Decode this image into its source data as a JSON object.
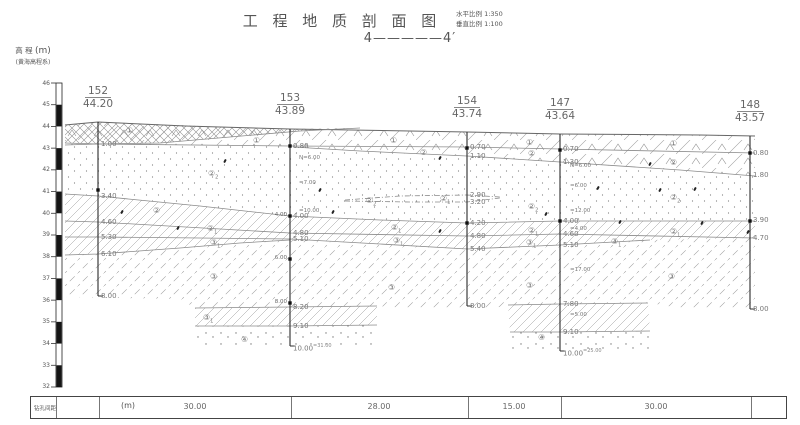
{
  "header": {
    "title": "工 程 地 质 剖 面 图",
    "scale_h_label": "水平比例",
    "scale_h_value": "1:350",
    "scale_v_label": "垂直比例",
    "scale_v_value": "1:100",
    "section_label": "4—————4′"
  },
  "axis": {
    "caption_line1": "高 程",
    "caption_unit": "(m)",
    "caption_line2": "(黄海高程系)",
    "ticks": [
      46,
      45,
      44,
      43,
      42,
      41,
      40,
      39,
      38,
      37,
      36,
      35,
      34,
      33,
      32
    ],
    "top_y": 83,
    "px_per_m": 21.714
  },
  "boreholes": [
    {
      "id": "152",
      "elevation": "44.20",
      "x": 98,
      "top": 122,
      "bottom": 296,
      "n_x": 0,
      "depth_labels": [
        {
          "t": "1.00",
          "y": 144
        },
        {
          "t": "3.40",
          "y": 196
        },
        {
          "t": "4.60",
          "y": 222
        },
        {
          "t": "5.30",
          "y": 237
        },
        {
          "t": "6.10",
          "y": 254
        },
        {
          "t": "8.00",
          "y": 296
        }
      ],
      "left_labels": [],
      "n_labels": [],
      "markers": [
        190
      ]
    },
    {
      "id": "153",
      "elevation": "43.89",
      "x": 290,
      "top": 129,
      "bottom": 346,
      "n_x": 299,
      "depth_labels": [
        {
          "t": "0.80",
          "y": 146
        },
        {
          "t": "4.00",
          "y": 216
        },
        {
          "t": "4.80",
          "y": 233
        },
        {
          "t": "5.10",
          "y": 239
        },
        {
          "t": "8.20",
          "y": 307
        },
        {
          "t": "9.10",
          "y": 326
        },
        {
          "t": "10.00",
          "y": 346,
          "sup": "=31.00"
        }
      ],
      "left_labels": [
        {
          "t": "4.00",
          "y": 215
        },
        {
          "t": "6.00",
          "y": 258
        },
        {
          "t": "8.00",
          "y": 302
        }
      ],
      "n_labels": [
        {
          "t": "N=6.00",
          "y": 158
        },
        {
          "t": "=7.00",
          "y": 183
        },
        {
          "t": "=10.00",
          "y": 211
        }
      ],
      "markers": [
        146,
        216,
        259,
        303
      ]
    },
    {
      "id": "154",
      "elevation": "43.74",
      "x": 467,
      "top": 132,
      "bottom": 306,
      "n_x": 0,
      "depth_labels": [
        {
          "t": "0.70",
          "y": 147
        },
        {
          "t": "1.10",
          "y": 156
        },
        {
          "t": "2.90",
          "y": 195
        },
        {
          "t": "3.20",
          "y": 202
        },
        {
          "t": "4.20",
          "y": 223
        },
        {
          "t": "4.80",
          "y": 236
        },
        {
          "t": "5.40",
          "y": 249
        },
        {
          "t": "8.00",
          "y": 306
        }
      ],
      "left_labels": [],
      "n_labels": [],
      "markers": [
        148,
        223
      ]
    },
    {
      "id": "147",
      "elevation": "43.64",
      "x": 560,
      "top": 134,
      "bottom": 351,
      "n_x": 570,
      "depth_labels": [
        {
          "t": "0.70",
          "y": 149
        },
        {
          "t": "1.30",
          "y": 162
        },
        {
          "t": "4.00",
          "y": 221
        },
        {
          "t": "4.60",
          "y": 234
        },
        {
          "t": "5.10",
          "y": 245
        },
        {
          "t": "7.80",
          "y": 304
        },
        {
          "t": "9.10",
          "y": 332
        },
        {
          "t": "10.00",
          "y": 351,
          "sup": "=25.00"
        }
      ],
      "left_labels": [],
      "n_labels": [
        {
          "t": "N=6.00",
          "y": 166
        },
        {
          "t": "=6.00",
          "y": 186
        },
        {
          "t": "=12.00",
          "y": 211
        },
        {
          "t": "=4.00",
          "y": 229
        },
        {
          "t": "=17.00",
          "y": 270
        },
        {
          "t": "=5.00",
          "y": 315
        }
      ],
      "markers": [
        150,
        221
      ]
    },
    {
      "id": "148",
      "elevation": "43.57",
      "x": 750,
      "top": 136,
      "bottom": 309,
      "n_x": 0,
      "depth_labels": [
        {
          "t": "0.80",
          "y": 153
        },
        {
          "t": "1.80",
          "y": 175
        },
        {
          "t": "3.90",
          "y": 220
        },
        {
          "t": "4.70",
          "y": 238
        },
        {
          "t": "8.00",
          "y": 309
        }
      ],
      "left_labels": [],
      "n_labels": [],
      "markers": [
        153,
        221
      ]
    }
  ],
  "strata_labels": [
    {
      "base": "①",
      "sub": "",
      "x": 126,
      "y": 126
    },
    {
      "base": "①",
      "sub": "",
      "x": 253,
      "y": 136
    },
    {
      "base": "①",
      "sub": "",
      "x": 390,
      "y": 136
    },
    {
      "base": "①",
      "sub": "",
      "x": 526,
      "y": 138
    },
    {
      "base": "①",
      "sub": "",
      "x": 670,
      "y": 139
    },
    {
      "base": "②",
      "sub": "",
      "x": 420,
      "y": 148
    },
    {
      "base": "②",
      "sub": "",
      "x": 528,
      "y": 149
    },
    {
      "base": "②",
      "sub": "",
      "x": 670,
      "y": 158
    },
    {
      "base": "②",
      "sub": "",
      "x": 153,
      "y": 206
    },
    {
      "base": "②",
      "sub": "2",
      "x": 208,
      "y": 169
    },
    {
      "base": "②",
      "sub": "2",
      "x": 366,
      "y": 196
    },
    {
      "base": "②",
      "sub": "2",
      "x": 528,
      "y": 202
    },
    {
      "base": "②",
      "sub": "2",
      "x": 670,
      "y": 193
    },
    {
      "base": "②",
      "sub": "1",
      "x": 207,
      "y": 224
    },
    {
      "base": "②",
      "sub": "1",
      "x": 391,
      "y": 223
    },
    {
      "base": "②",
      "sub": "1",
      "x": 528,
      "y": 226
    },
    {
      "base": "②",
      "sub": "1",
      "x": 670,
      "y": 227
    },
    {
      "base": "②",
      "sub": "1",
      "x": 440,
      "y": 194
    },
    {
      "base": "③",
      "sub": "1",
      "x": 210,
      "y": 238
    },
    {
      "base": "③",
      "sub": "1",
      "x": 393,
      "y": 236
    },
    {
      "base": "③",
      "sub": "1",
      "x": 526,
      "y": 238
    },
    {
      "base": "③",
      "sub": "1",
      "x": 611,
      "y": 237
    },
    {
      "base": "③",
      "sub": "1",
      "x": 203,
      "y": 313
    },
    {
      "base": "③",
      "sub": "",
      "x": 210,
      "y": 272
    },
    {
      "base": "③",
      "sub": "",
      "x": 388,
      "y": 283
    },
    {
      "base": "③",
      "sub": "",
      "x": 526,
      "y": 281
    },
    {
      "base": "③",
      "sub": "",
      "x": 668,
      "y": 272
    },
    {
      "base": "④",
      "sub": "",
      "x": 241,
      "y": 335
    },
    {
      "base": "④",
      "sub": "",
      "x": 538,
      "y": 333
    }
  ],
  "boundaries": [
    {
      "name": "ground-surface",
      "color": "#666",
      "w": 1,
      "pts": "65,125 98,122 185,126 290,129 467,132 560,134 700,135 755,136"
    },
    {
      "name": "fill-1-bottom",
      "pts": "65,145 98,144 290,146 467,147 560,149 755,153"
    },
    {
      "name": "fill-2-bottom",
      "pts": "293,147 360,151 467,156 560,162 680,170 755,176"
    },
    {
      "name": "fill-x-wedge",
      "pts": "65,143 98,144 160,143 230,137 300,131 360,128"
    },
    {
      "name": "layer-2-2-bottom",
      "pts": "65,194 98,196 200,206 290,216 380,220 467,223 560,221 660,221 755,221"
    },
    {
      "name": "layer-2-1-bottom",
      "pts": "65,221 98,222 290,233 467,236 560,234 755,238"
    },
    {
      "name": "layer-3-1-bottom",
      "pts": "65,237 98,237 200,238 290,239 380,244 467,249 560,245 650,240"
    },
    {
      "name": "layer-3-1-left-bottom",
      "pts": "65,255 98,254 180,248 240,243 290,240"
    },
    {
      "name": "lens-153-top",
      "pts": "195,308 290,307 377,306"
    },
    {
      "name": "lens-153-bottom",
      "pts": "195,326 290,326 377,325"
    },
    {
      "name": "lens-147-top",
      "pts": "508,305 560,304 648,303"
    },
    {
      "name": "lens-147-bottom",
      "pts": "510,332 560,332 650,331"
    },
    {
      "name": "dash-lens-top",
      "dash": "5 2 1 2",
      "pts": "345,200 400,196 467,195 500,197"
    },
    {
      "name": "dash-lens-bottom",
      "dash": "5 2 1 2",
      "pts": "345,201 410,202 467,202 500,198"
    }
  ],
  "regions": [
    {
      "name": "fill-layer-1",
      "pattern": "tri",
      "pts": "65,125 98,122 290,129 467,132 560,134 755,136 755,153 560,149 467,147 290,146 98,144 65,145"
    },
    {
      "name": "fill-x-wedge",
      "pattern": "x",
      "pts": "65,125 98,122 200,126 290,129 360,128 300,131 230,137 160,143 98,144 65,143"
    },
    {
      "name": "fill-layer-2",
      "pattern": "tri",
      "pts": "293,147 467,147 560,149 755,153 755,176 680,170 560,162 467,156 360,151"
    },
    {
      "name": "silt-2-2",
      "pattern": "dots",
      "pts": "65,145 98,144 290,146 360,151 467,156 560,162 755,176 755,221 660,221 560,221 467,223 290,216 98,196 65,194"
    },
    {
      "name": "band-2-1",
      "pattern": "h1",
      "pts": "65,194 98,196 200,206 290,216 380,220 467,223 560,221 660,221 755,221 755,238 560,234 467,236 290,233 98,222 65,221"
    },
    {
      "name": "band-3-1",
      "pattern": "h1",
      "pts": "65,221 98,222 290,233 467,236 560,234 755,238 650,240 560,245 467,249 290,239 98,237 65,237"
    },
    {
      "name": "band-3-1-left",
      "pattern": "h1",
      "pts": "65,237 98,237 200,238 290,239 290,240 240,243 180,248 98,254 65,255"
    },
    {
      "name": "clay-3",
      "pattern": "h2",
      "pts": "65,255 98,254 180,248 240,243 290,240 380,244 467,249 560,245 650,240 755,238 755,309 680,308 650,303 560,304 508,305 495,308 420,309 377,306 290,307 195,308 180,299 65,297"
    },
    {
      "name": "lens-153",
      "pattern": "h1",
      "pts": "195,308 377,306 377,325 195,326"
    },
    {
      "name": "lens-147",
      "pattern": "h1",
      "pts": "508,305 648,303 650,331 510,332"
    },
    {
      "name": "sand-4-153",
      "pattern": "dots2",
      "pts": "195,326 377,325 377,347 195,347"
    },
    {
      "name": "sand-4-147",
      "pattern": "dots2",
      "pts": "510,332 650,331 650,352 510,352"
    }
  ],
  "scatter_marks": [
    [
      225,
      161
    ],
    [
      440,
      158
    ],
    [
      650,
      164
    ],
    [
      122,
      212
    ],
    [
      333,
      212
    ],
    [
      546,
      214
    ],
    [
      695,
      189
    ],
    [
      660,
      190
    ],
    [
      178,
      228
    ],
    [
      440,
      231
    ],
    [
      620,
      222
    ],
    [
      702,
      223
    ],
    [
      748,
      232
    ],
    [
      320,
      190
    ],
    [
      598,
      188
    ]
  ],
  "spacing_row": {
    "label": "钻孔间距",
    "unit": "(m)",
    "values": [
      "",
      "30.00",
      "28.00",
      "15.00",
      "30.00",
      ""
    ]
  }
}
